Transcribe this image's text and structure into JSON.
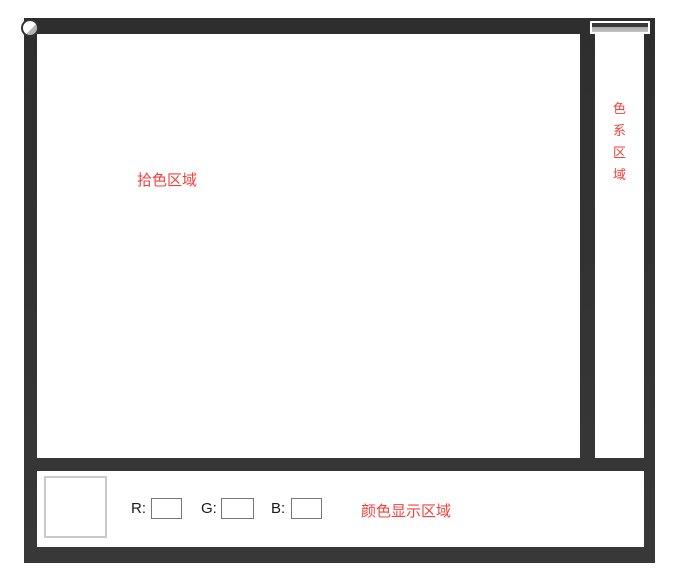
{
  "picker_area": {
    "label": "拾色区域"
  },
  "hue_strip": {
    "label_chars": [
      "色",
      "系",
      "区",
      "域"
    ]
  },
  "display_area": {
    "label": "颜色显示区域",
    "r_label": "R:",
    "g_label": "G:",
    "b_label": "B:",
    "r_value": "",
    "g_value": "",
    "b_value": ""
  },
  "colors": {
    "frame": "#333333",
    "accent_red": "#f2423c",
    "panel_background": "#ffffff",
    "input_border": "#767676",
    "swatch_border": "#c9c9c9",
    "handle_gray": "#b5b5b5"
  }
}
